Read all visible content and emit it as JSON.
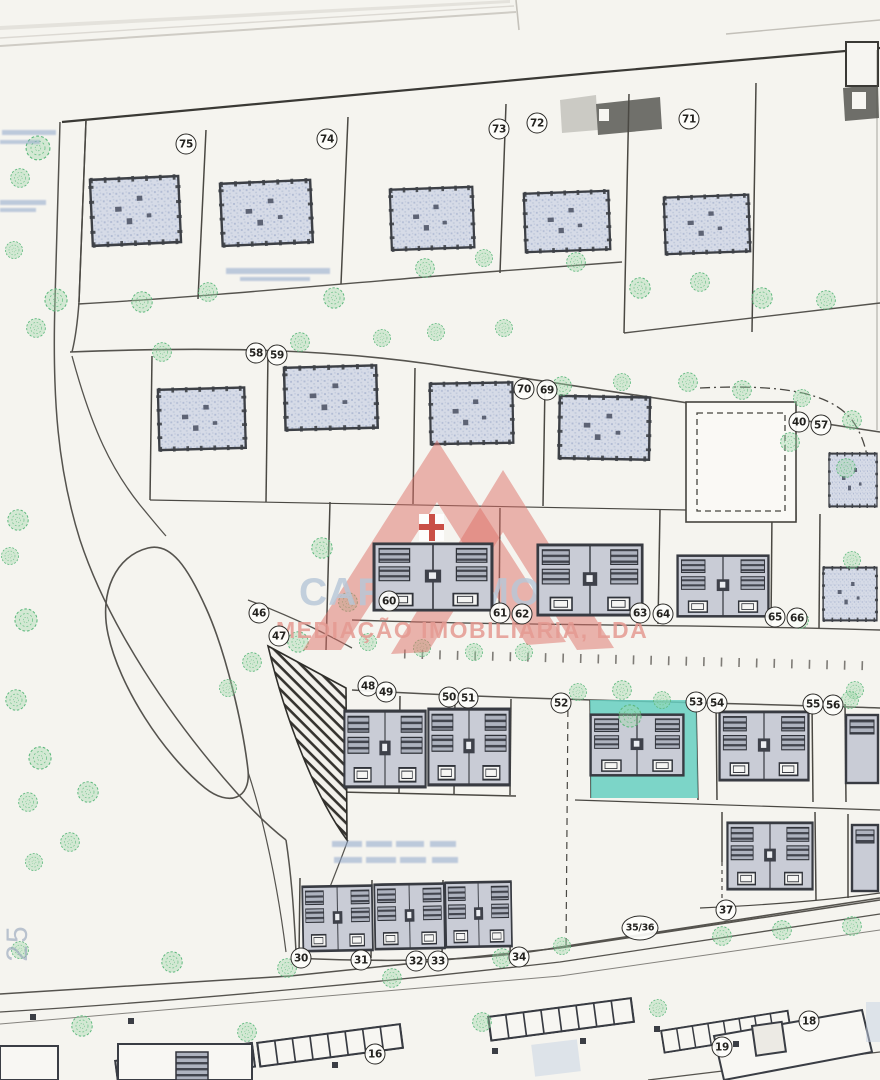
{
  "watermark": {
    "brand": "CARTAXIMOVE",
    "tagline": "MEDIAÇÃO IMOBILIÁRIA, LDA"
  },
  "edge_label": "25",
  "colors": {
    "highlight_teal": "#66cfc1",
    "logo_salmon": "#dd7068",
    "brand_blue": "#b8c7d8",
    "tagline_salmon": "#e59a92",
    "building_fill": "#ccd2df",
    "tree_green": "#5cb87c",
    "paper": "#f5f4ef",
    "ink": "#3a3d44"
  },
  "lot_markers": [
    {
      "n": "75",
      "x": 186,
      "y": 144
    },
    {
      "n": "74",
      "x": 327,
      "y": 139
    },
    {
      "n": "73",
      "x": 499,
      "y": 129
    },
    {
      "n": "72",
      "x": 537,
      "y": 123
    },
    {
      "n": "71",
      "x": 689,
      "y": 119
    },
    {
      "n": "58",
      "x": 256,
      "y": 353
    },
    {
      "n": "59",
      "x": 277,
      "y": 355
    },
    {
      "n": "70",
      "x": 524,
      "y": 389
    },
    {
      "n": "69",
      "x": 547,
      "y": 390
    },
    {
      "n": "40",
      "x": 799,
      "y": 422
    },
    {
      "n": "57",
      "x": 821,
      "y": 425
    },
    {
      "n": "60",
      "x": 389,
      "y": 601
    },
    {
      "n": "61",
      "x": 500,
      "y": 613
    },
    {
      "n": "62",
      "x": 522,
      "y": 614
    },
    {
      "n": "63",
      "x": 640,
      "y": 613
    },
    {
      "n": "64",
      "x": 663,
      "y": 614
    },
    {
      "n": "65",
      "x": 775,
      "y": 617
    },
    {
      "n": "66",
      "x": 797,
      "y": 618
    },
    {
      "n": "46",
      "x": 259,
      "y": 613
    },
    {
      "n": "47",
      "x": 279,
      "y": 636
    },
    {
      "n": "48",
      "x": 368,
      "y": 686
    },
    {
      "n": "49",
      "x": 386,
      "y": 692
    },
    {
      "n": "50",
      "x": 449,
      "y": 697
    },
    {
      "n": "51",
      "x": 468,
      "y": 698
    },
    {
      "n": "52",
      "x": 561,
      "y": 703
    },
    {
      "n": "53",
      "x": 696,
      "y": 702
    },
    {
      "n": "54",
      "x": 717,
      "y": 703
    },
    {
      "n": "55",
      "x": 813,
      "y": 704
    },
    {
      "n": "56",
      "x": 833,
      "y": 705
    },
    {
      "n": "30",
      "x": 301,
      "y": 958
    },
    {
      "n": "31",
      "x": 361,
      "y": 960
    },
    {
      "n": "32",
      "x": 416,
      "y": 961
    },
    {
      "n": "33",
      "x": 438,
      "y": 961
    },
    {
      "n": "34",
      "x": 519,
      "y": 957
    },
    {
      "n": "35/36",
      "x": 640,
      "y": 928
    },
    {
      "n": "37",
      "x": 726,
      "y": 910
    },
    {
      "n": "16",
      "x": 375,
      "y": 1054
    },
    {
      "n": "19",
      "x": 722,
      "y": 1047
    },
    {
      "n": "18",
      "x": 809,
      "y": 1021
    }
  ]
}
